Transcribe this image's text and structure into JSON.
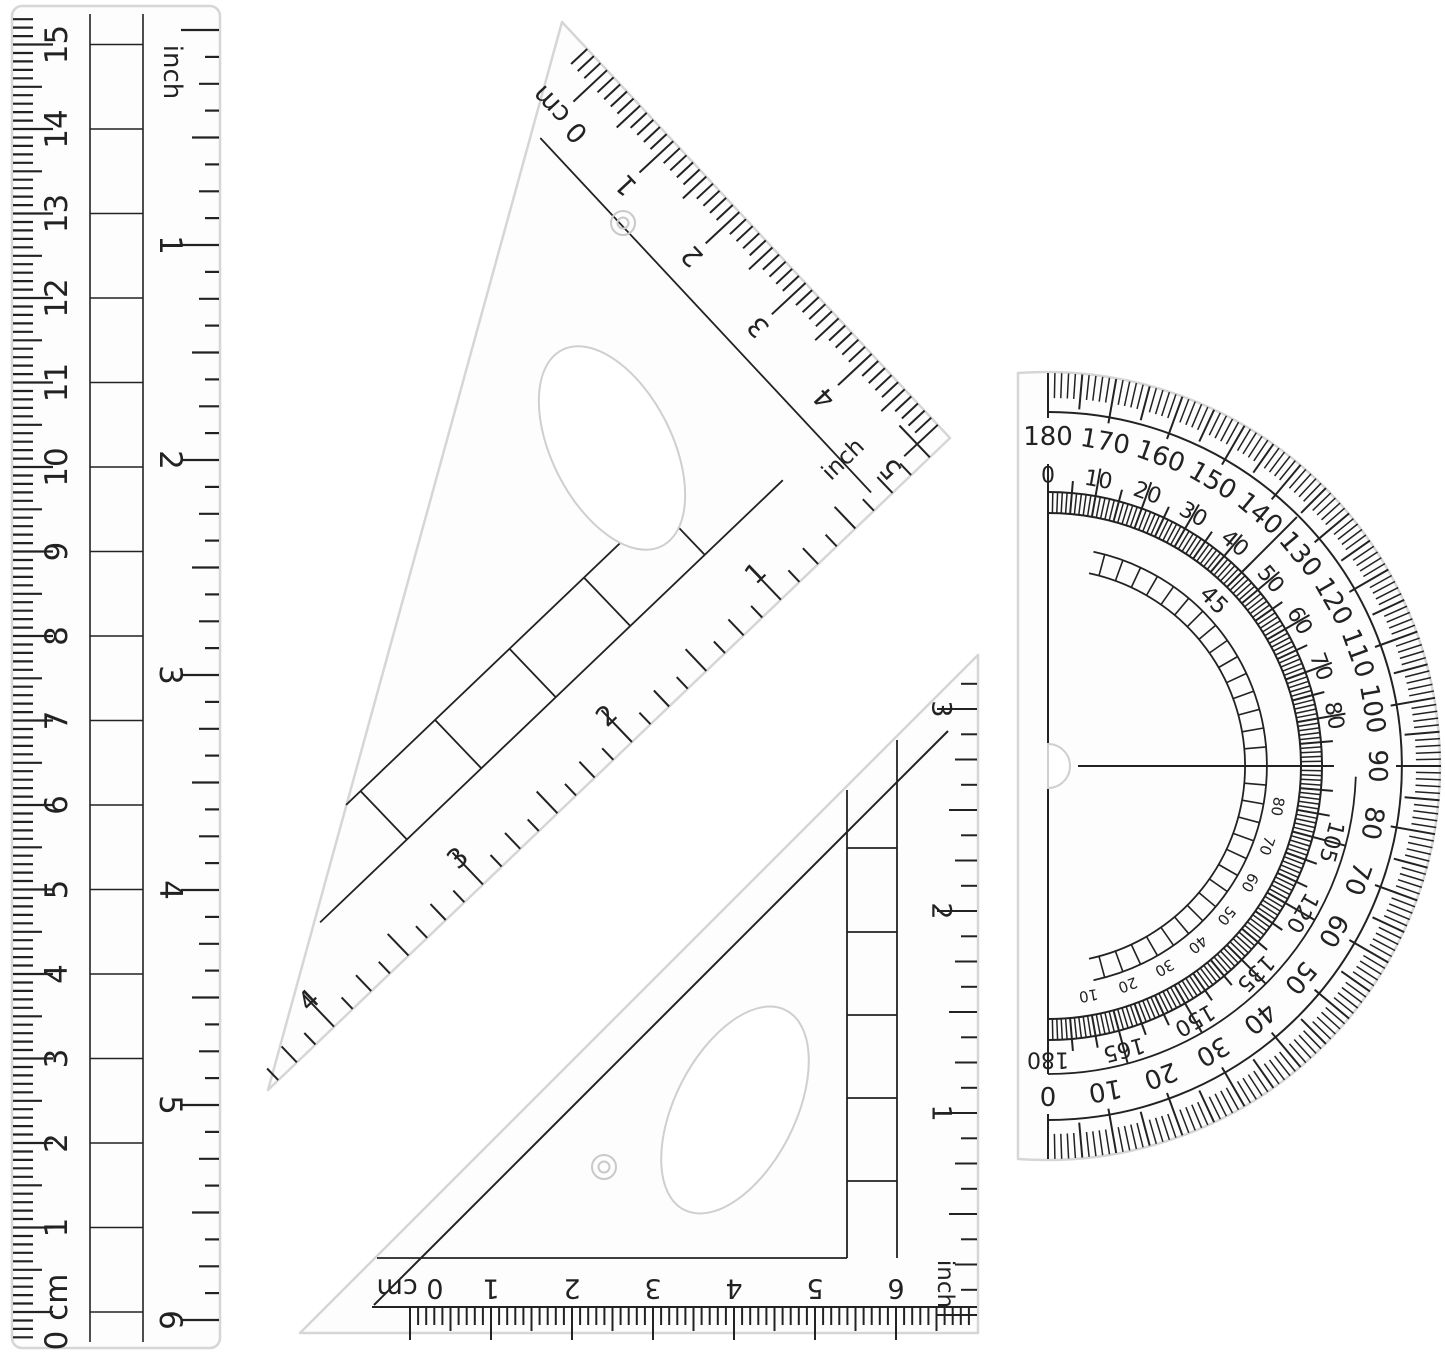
{
  "colors": {
    "ink": "#222222",
    "plastic_edge": "#d6d6d6",
    "plastic_fill": "#fdfdfd",
    "background": "#ffffff",
    "hole_edge": "#cfcfcf"
  },
  "ruler": {
    "cm_unit": "cm",
    "inch_unit": "inch",
    "cm_numbers": [
      0,
      1,
      2,
      3,
      4,
      5,
      6,
      7,
      8,
      9,
      10,
      11,
      12,
      13,
      14,
      15
    ],
    "inch_numbers": [
      1,
      2,
      3,
      4,
      5,
      6
    ]
  },
  "square30": {
    "zero_label": "0 cm",
    "cm_numbers": [
      1,
      2,
      3,
      4,
      5
    ],
    "inch_label": "inch",
    "inch_numbers": [
      1,
      2,
      3,
      4
    ]
  },
  "square45": {
    "zero_label": "0 cm",
    "cm_numbers": [
      1,
      2,
      3,
      4,
      5,
      6
    ],
    "inch_label": "inch",
    "inch_numbers": [
      1,
      2,
      3
    ]
  },
  "protractor": {
    "outer_numbers": [
      180,
      170,
      160,
      150,
      140,
      130,
      120,
      110,
      100,
      90,
      80,
      70,
      60,
      50,
      40,
      30,
      20,
      10,
      0
    ],
    "inner_top_numbers": [
      0,
      10,
      20,
      30,
      40,
      50,
      60,
      70,
      80
    ],
    "inner_bottom_numbers": [
      105,
      120,
      135,
      150,
      165,
      180
    ],
    "quadrant_numbers": [
      80,
      70,
      60,
      50,
      40,
      30,
      20,
      10
    ],
    "mid_label": "45"
  }
}
